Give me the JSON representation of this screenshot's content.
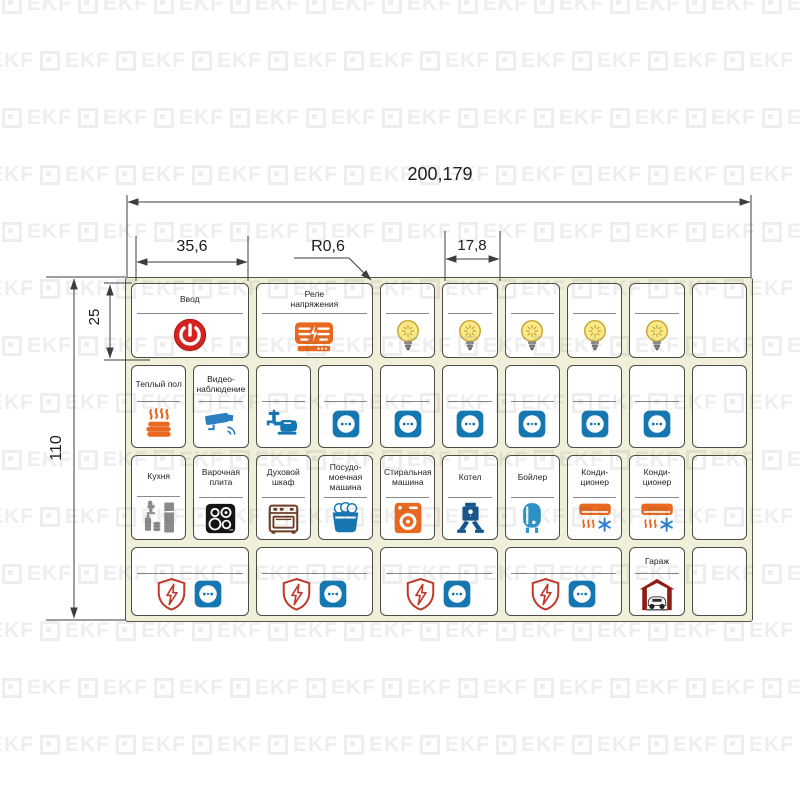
{
  "watermark": {
    "text": "EKF"
  },
  "dimensions": {
    "total_width_mm": "200,179",
    "label_cell_width_mm": "35,6",
    "corner_radius_mm": "R0,6",
    "module_width_mm": "17,8",
    "first_row_height_mm": "25",
    "total_height_mm": "110"
  },
  "colors": {
    "sheet_bg": "#f0efda",
    "sheet_border": "#55554a",
    "cell_border": "#4c4c44",
    "divider": "#8a8a8a",
    "dim_line": "#3c3c3c",
    "red": "#d6211e",
    "orange": "#e8691f",
    "socket_blue": "#1577b2",
    "camera_blue": "#2d7fc1",
    "light_blue": "#2b93c8",
    "dark_blue": "#15568c",
    "bulb_yellow": "#f7e98c",
    "bulb_stroke": "#c9a22b",
    "appliance_gray": "#8a8a8a",
    "cooktop_black": "#141414",
    "oven_brown": "#6e3b23",
    "dark_red": "#8f1d15",
    "shield_red": "#c0392b",
    "snow_blue": "#2a7fd4"
  },
  "sheet": {
    "rows": [
      {
        "cells": [
          {
            "name": "cell-input",
            "label": "Ввод",
            "span": 2,
            "divider": true,
            "icons": [
              "power"
            ]
          },
          {
            "name": "cell-voltage-relay",
            "label": "Реле напряжения",
            "span": 2,
            "divider": true,
            "icons": [
              "relay"
            ]
          },
          {
            "name": "cell-light",
            "label": "",
            "span": 1,
            "divider": true,
            "icons": [
              "bulb"
            ]
          },
          {
            "name": "cell-light",
            "label": "",
            "span": 1,
            "divider": true,
            "icons": [
              "bulb"
            ]
          },
          {
            "name": "cell-light",
            "label": "",
            "span": 1,
            "divider": true,
            "icons": [
              "bulb"
            ]
          },
          {
            "name": "cell-light",
            "label": "",
            "span": 1,
            "divider": true,
            "icons": [
              "bulb"
            ]
          },
          {
            "name": "cell-light",
            "label": "",
            "span": 1,
            "divider": true,
            "icons": [
              "bulb"
            ]
          },
          {
            "name": "cell-empty",
            "label": "",
            "span": 1,
            "divider": false,
            "icons": []
          }
        ]
      },
      {
        "cells": [
          {
            "name": "cell-heated-floor",
            "label": "Теплый пол",
            "span": 1,
            "divider": true,
            "icons": [
              "heated-floor"
            ]
          },
          {
            "name": "cell-cctv",
            "label": "Видео-наблюдение",
            "span": 1,
            "divider": true,
            "icons": [
              "cctv"
            ]
          },
          {
            "name": "cell-water-pump",
            "label": "",
            "span": 1,
            "divider": true,
            "icons": [
              "water-pump"
            ]
          },
          {
            "name": "cell-socket",
            "label": "",
            "span": 1,
            "divider": true,
            "icons": [
              "socket"
            ]
          },
          {
            "name": "cell-socket",
            "label": "",
            "span": 1,
            "divider": true,
            "icons": [
              "socket"
            ]
          },
          {
            "name": "cell-socket",
            "label": "",
            "span": 1,
            "divider": true,
            "icons": [
              "socket"
            ]
          },
          {
            "name": "cell-socket",
            "label": "",
            "span": 1,
            "divider": true,
            "icons": [
              "socket"
            ]
          },
          {
            "name": "cell-socket",
            "label": "",
            "span": 1,
            "divider": true,
            "icons": [
              "socket"
            ]
          },
          {
            "name": "cell-socket",
            "label": "",
            "span": 1,
            "divider": true,
            "icons": [
              "socket"
            ]
          },
          {
            "name": "cell-empty",
            "label": "",
            "span": 1,
            "divider": false,
            "icons": []
          }
        ]
      },
      {
        "cells": [
          {
            "name": "cell-kitchen",
            "label": "Кухня",
            "span": 1,
            "divider": true,
            "icons": [
              "kitchen"
            ]
          },
          {
            "name": "cell-cooktop",
            "label": "Варочная плита",
            "span": 1,
            "divider": true,
            "icons": [
              "cooktop"
            ]
          },
          {
            "name": "cell-oven",
            "label": "Духовой шкаф",
            "span": 1,
            "divider": true,
            "icons": [
              "oven"
            ]
          },
          {
            "name": "cell-dishwasher",
            "label": "Посудо-моечная машина",
            "span": 1,
            "divider": true,
            "icons": [
              "dishwasher"
            ]
          },
          {
            "name": "cell-washing-machine",
            "label": "Стиральная машина",
            "span": 1,
            "divider": true,
            "icons": [
              "washer"
            ]
          },
          {
            "name": "cell-boiler",
            "label": "Котел",
            "span": 1,
            "divider": true,
            "icons": [
              "boiler"
            ]
          },
          {
            "name": "cell-water-heater",
            "label": "Бойлер",
            "span": 1,
            "divider": true,
            "icons": [
              "water-heater"
            ]
          },
          {
            "name": "cell-air-conditioner",
            "label": "Конди-ционер",
            "span": 1,
            "divider": true,
            "icons": [
              "ac"
            ]
          },
          {
            "name": "cell-air-conditioner",
            "label": "Конди-ционер",
            "span": 1,
            "divider": true,
            "icons": [
              "ac"
            ]
          },
          {
            "name": "cell-empty",
            "label": "",
            "span": 1,
            "divider": false,
            "icons": []
          }
        ]
      },
      {
        "cells": [
          {
            "name": "cell-protected-socket",
            "label": "",
            "span": 2,
            "divider": true,
            "icons": [
              "shield",
              "socket"
            ]
          },
          {
            "name": "cell-protected-socket",
            "label": "",
            "span": 2,
            "divider": true,
            "icons": [
              "shield",
              "socket"
            ]
          },
          {
            "name": "cell-protected-socket",
            "label": "",
            "span": 2,
            "divider": true,
            "icons": [
              "shield",
              "socket"
            ]
          },
          {
            "name": "cell-protected-socket",
            "label": "",
            "span": 2,
            "divider": true,
            "icons": [
              "shield",
              "socket"
            ]
          },
          {
            "name": "cell-garage",
            "label": "Гараж",
            "span": 1,
            "divider": true,
            "icons": [
              "garage"
            ]
          },
          {
            "name": "cell-empty",
            "label": "",
            "span": 1,
            "divider": false,
            "icons": []
          }
        ]
      }
    ]
  }
}
